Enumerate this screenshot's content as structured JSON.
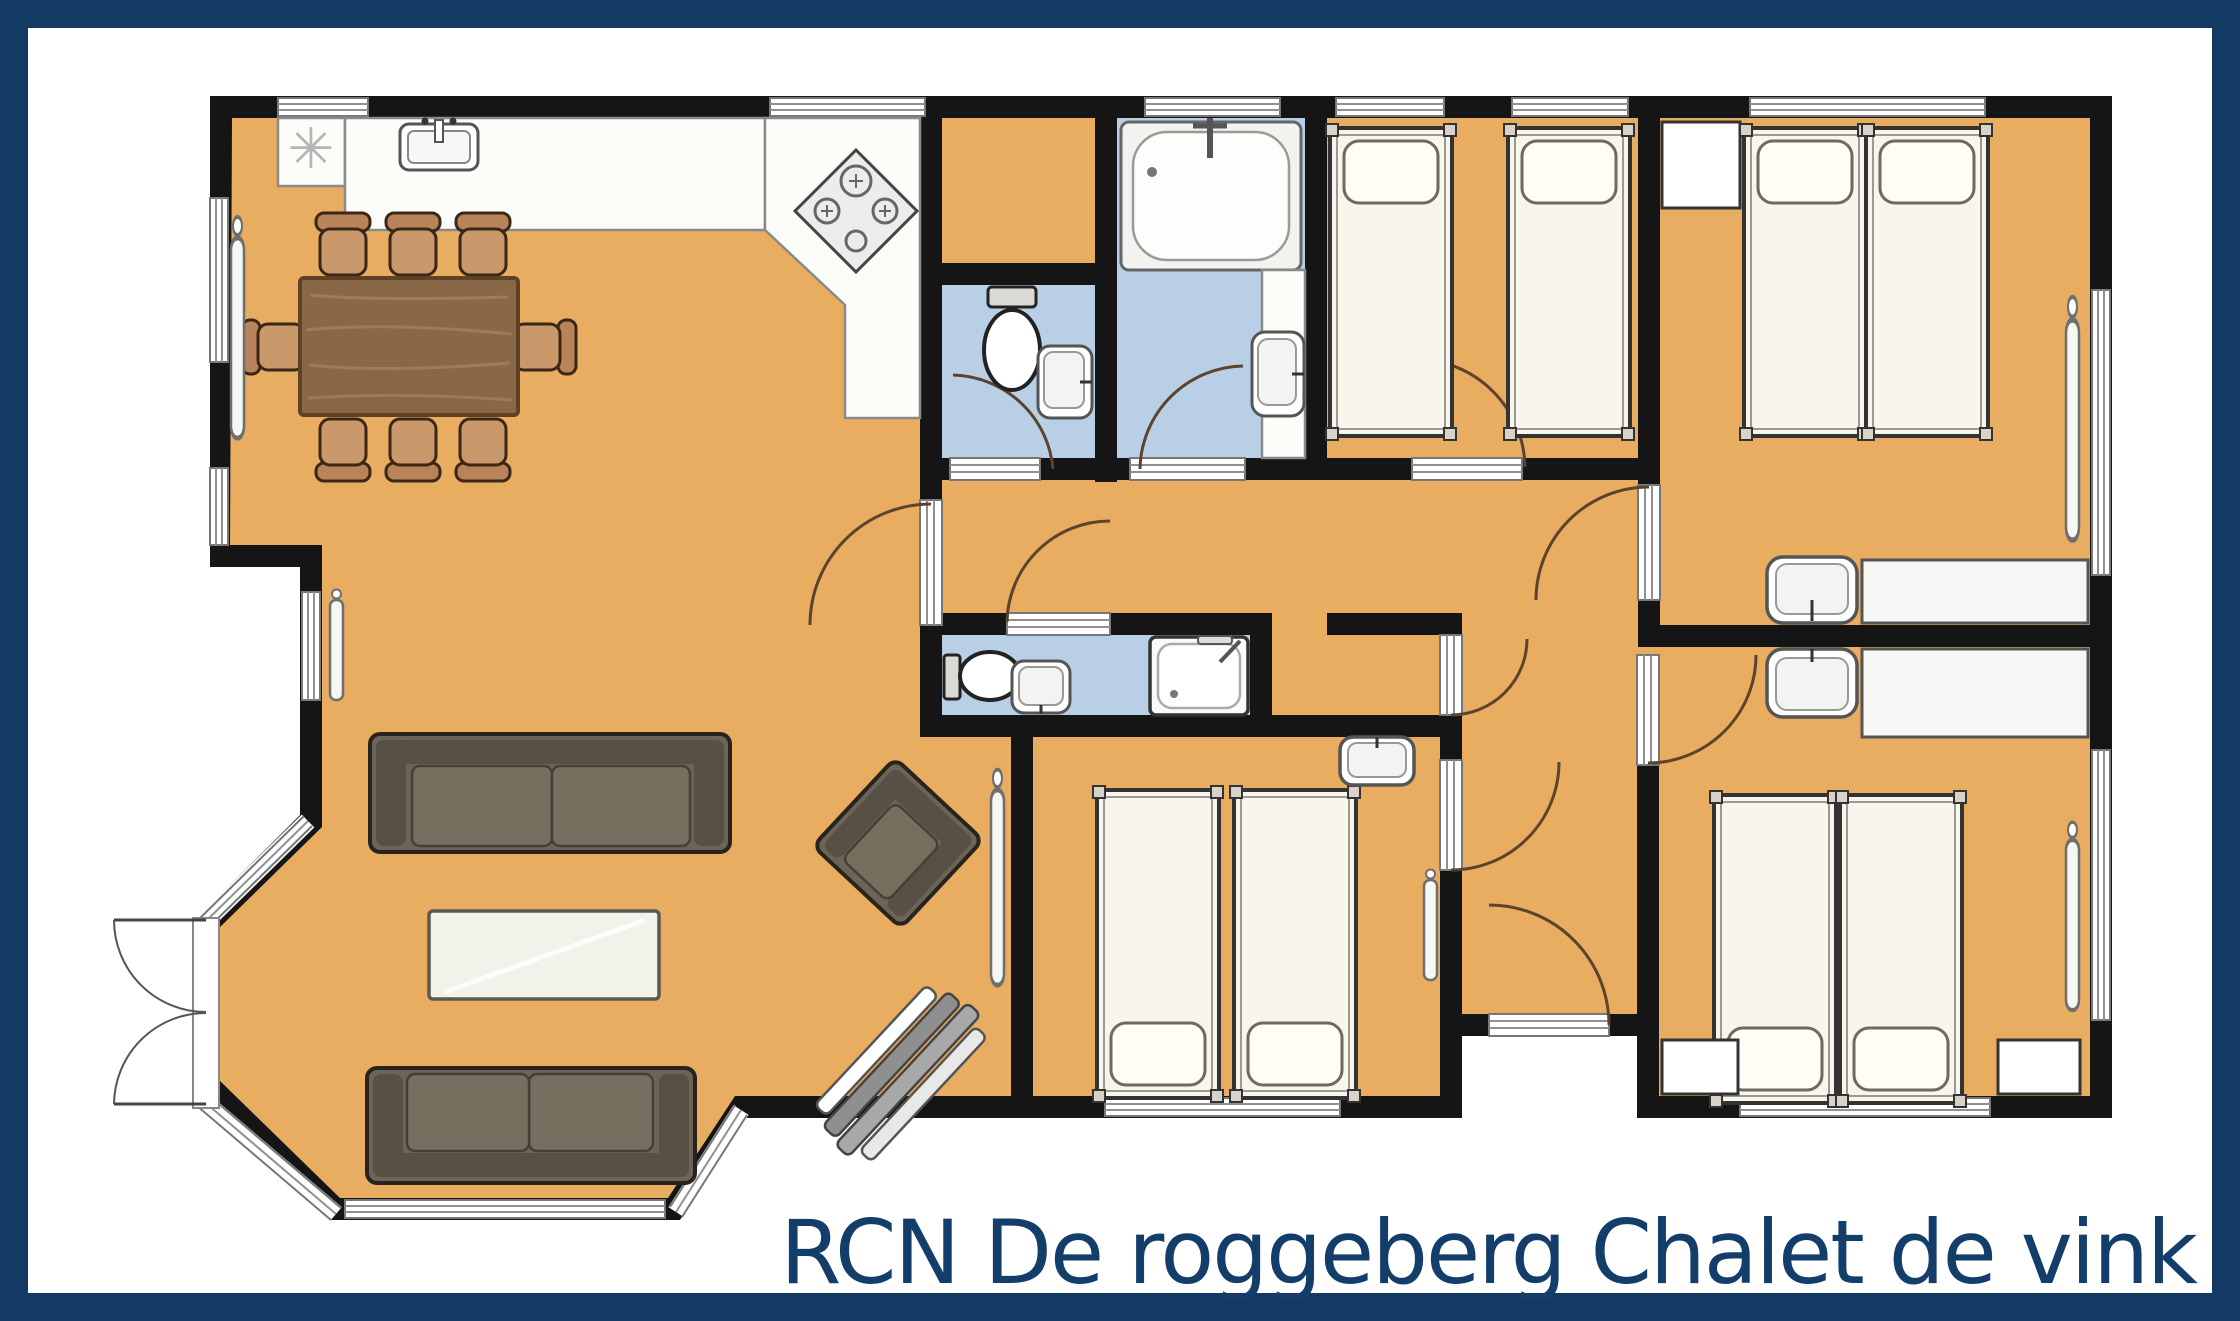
{
  "title": {
    "text": "RCN De roggeberg Chalet de vink"
  },
  "icons": {
    "freezer_glyph": "✳"
  },
  "colors": {
    "frame": "#123a63",
    "title_color": "#143e6a",
    "background": "#ffffff",
    "wall": "#151515",
    "floor": "#e8ad60",
    "wet_floor": "#b9cfe6",
    "counter": "#fcfcf9",
    "counter_line": "#8a8a8a",
    "wood": "#8a6746",
    "wood_dark": "#5e4226",
    "wood_light": "#a5805a",
    "chair": "#c9996b",
    "chair_back": "#b9845a",
    "sofa": "#6c6557",
    "sofa_dark": "#575044",
    "cushion": "#766e5e",
    "bed": "#f8f5ec",
    "pillow": "#fffdf6",
    "fixture": "#ffffff",
    "fixture_gray": "#e3e3e1",
    "outline": "#333333",
    "door_arc": "#5b432e",
    "window_line": "#909090",
    "glass": "#f2f2ea"
  }
}
